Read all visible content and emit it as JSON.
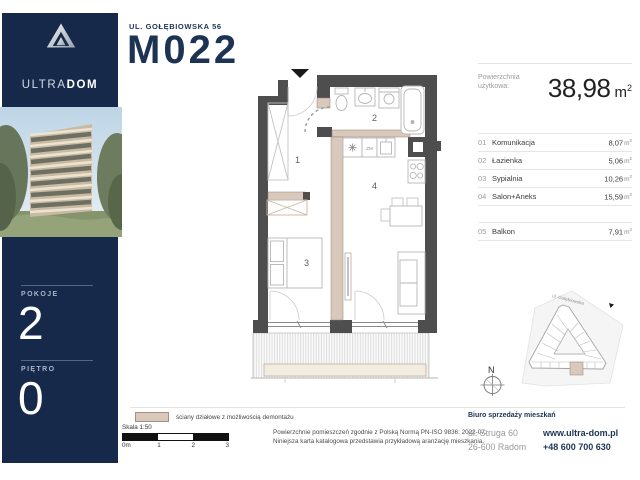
{
  "branding": {
    "name_light": "ULTRA",
    "name_bold": "DOM"
  },
  "header": {
    "street": "UL. GOŁĘBIOWSKA 56",
    "unit": "M022"
  },
  "sidebar": {
    "rooms_label": "POKOJE",
    "rooms_value": "2",
    "floor_label": "PIĘTRO",
    "floor_value": "0"
  },
  "area_summary": {
    "label_line1": "Powierzchnia",
    "label_line2": "użytkowa:",
    "value": "38,98",
    "unit": "m",
    "unit_sup": "2"
  },
  "rooms": [
    {
      "no": "01",
      "name": "Komunikacja",
      "area": "8,07"
    },
    {
      "no": "02",
      "name": "Łazienka",
      "area": "5,06"
    },
    {
      "no": "03",
      "name": "Sypialnia",
      "area": "10,26"
    },
    {
      "no": "04",
      "name": "Salon+Aneks",
      "area": "15,59"
    },
    {
      "no": "05",
      "name": "Balkon",
      "area": "7,91"
    }
  ],
  "area_unit": {
    "m": "m",
    "sup": "2"
  },
  "plan": {
    "labels": {
      "hall": "1",
      "bath": "2",
      "bed": "3",
      "living": "4"
    },
    "kitchen_label": "ZM"
  },
  "legend": {
    "text": "ściany działowe z możliwością demontażu"
  },
  "scale": {
    "label": "Skala 1:50",
    "ticks": [
      "0m",
      "1",
      "2",
      "3"
    ]
  },
  "legal": {
    "line1": "Powierzchnie pomieszczeń zgodnie z Polską Normą PN-ISO 9836: 2022-07.",
    "line2": "Niniejsza karta katalogowa przedstawia przykładową aranżację mieszkania."
  },
  "contact": {
    "office": "Biuro sprzedaży mieszkań",
    "address1": "ul. Struga 60",
    "address2": "26-600 Radom",
    "website": "www.ultra-dom.pl",
    "phone": "+48 600 700 630"
  },
  "sitemap": {
    "street_label": "ul. Gołębiowska",
    "north": "N"
  },
  "colors": {
    "navy": "#16294a",
    "wall": "#4e4e4e",
    "demountable": "#d9c9bd"
  }
}
